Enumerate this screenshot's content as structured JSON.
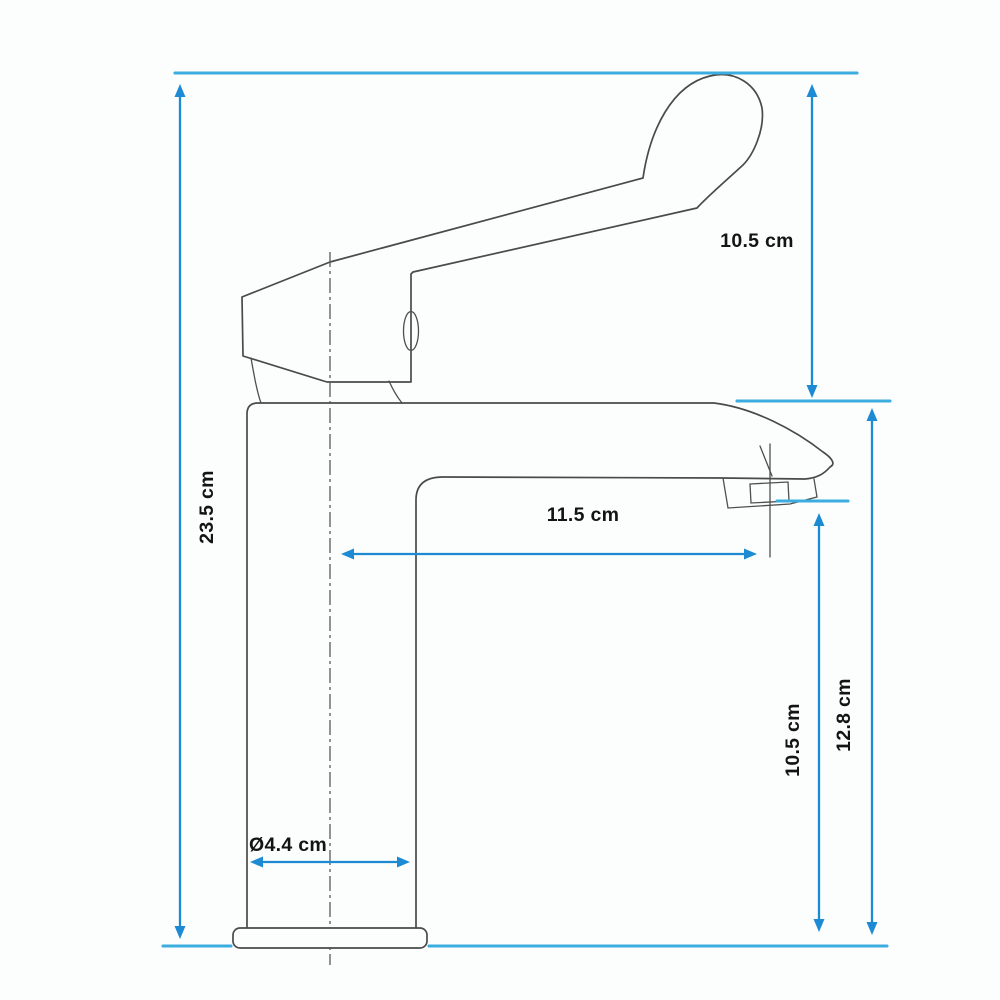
{
  "diagram": {
    "kind": "technical dimension drawing",
    "subject": "single-lever basin mixer tap, side elevation",
    "units": "cm",
    "colors": {
      "extent_line_blue": "#3badde",
      "dimension_arrow_blue": "#1d8bd3",
      "drawing_outline_gray": "#4a4a4a",
      "label_text": "#141414",
      "background": "#fcfdfd"
    },
    "dimensions": {
      "total_height": {
        "label": "23.5 cm",
        "value": 23.5,
        "orientation": "vertical",
        "position": "left"
      },
      "handle_height": {
        "label": "10.5 cm",
        "value": 10.5,
        "orientation": "vertical",
        "position": "upper-right"
      },
      "spout_reach": {
        "label": "11.5 cm",
        "value": 11.5,
        "orientation": "horizontal",
        "position": "middle"
      },
      "outlet_height": {
        "label": "10.5 cm",
        "value": 10.5,
        "orientation": "vertical",
        "position": "lower-right-inner"
      },
      "spout_top_height": {
        "label": "12.8 cm",
        "value": 12.8,
        "orientation": "vertical",
        "position": "lower-right-outer"
      },
      "base_diameter": {
        "label": "Ø4.4 cm",
        "value": 4.4,
        "orientation": "horizontal",
        "position": "base"
      }
    }
  }
}
